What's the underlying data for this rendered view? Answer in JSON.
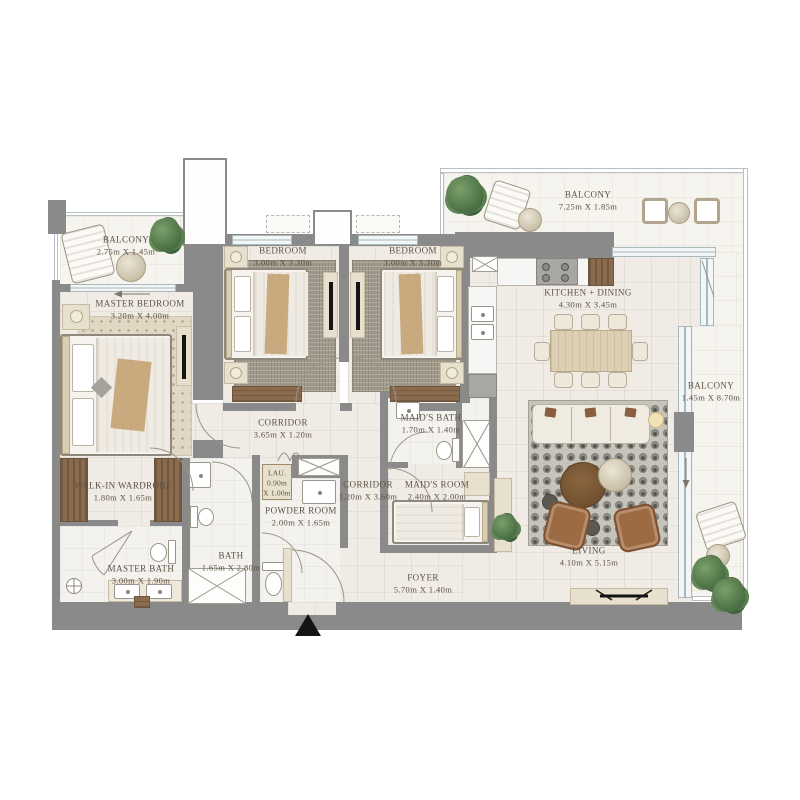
{
  "rooms": [
    {
      "id": "balcony-tl",
      "name": "BALCONY",
      "dims": "2.75m X 1.45m"
    },
    {
      "id": "master-bedroom",
      "name": "MASTER BEDROOM",
      "dims": "3.20m X 4.00m"
    },
    {
      "id": "bedroom-1",
      "name": "BEDROOM",
      "dims": "3.00m X 3.30m"
    },
    {
      "id": "bedroom-2",
      "name": "BEDROOM",
      "dims": "3.00m X 3.30m"
    },
    {
      "id": "kitchen-dining",
      "name": "KITCHEN + DINING",
      "dims": "4.30m X 3.45m"
    },
    {
      "id": "balcony-top",
      "name": "BALCONY",
      "dims": "7.25m X 1.85m"
    },
    {
      "id": "balcony-right",
      "name": "BALCONY",
      "dims": "1.45m X 8.70m"
    },
    {
      "id": "corridor-1",
      "name": "CORRIDOR",
      "dims": "3.65m X 1.20m"
    },
    {
      "id": "laundry",
      "name": "LAU.",
      "dims_line1": "0.90m",
      "dims_line2": "X 1.00m"
    },
    {
      "id": "corridor-2",
      "name": "CORRIDOR",
      "dims": "1.20m X 3.60m"
    },
    {
      "id": "powder-room",
      "name": "POWDER ROOM",
      "dims": "2.00m X 1.65m"
    },
    {
      "id": "maids-bath",
      "name": "MAID'S BATH",
      "dims": "1.70m X 1.40m"
    },
    {
      "id": "maids-room",
      "name": "MAID'S ROOM",
      "dims": "2.40m X 2.00m"
    },
    {
      "id": "walk-in-wardrobe",
      "name": "WALK-IN WARDROBE",
      "dims": "1.80m X 1.65m"
    },
    {
      "id": "master-bath",
      "name": "MASTER BATH",
      "dims": "3.00m X 1.90m"
    },
    {
      "id": "bath",
      "name": "BATH",
      "dims": "1.65m X 2.80m"
    },
    {
      "id": "foyer",
      "name": "FOYER",
      "dims": "5.70m X 1.40m"
    },
    {
      "id": "living",
      "name": "LIVING",
      "dims": "4.10m X 5.15m"
    }
  ],
  "colors": {
    "wall": "#8a8a8a",
    "floor": "#f0ece5",
    "balcony_floor": "#f6f4ee",
    "wood": "#8a6b4e",
    "beige": "#e8e0cf",
    "living_rug": "#c6c3ba",
    "armchair": "#9c6b44",
    "plant": "#4f7347",
    "label_text": "#5b5244",
    "entry_marker": "#141414"
  }
}
